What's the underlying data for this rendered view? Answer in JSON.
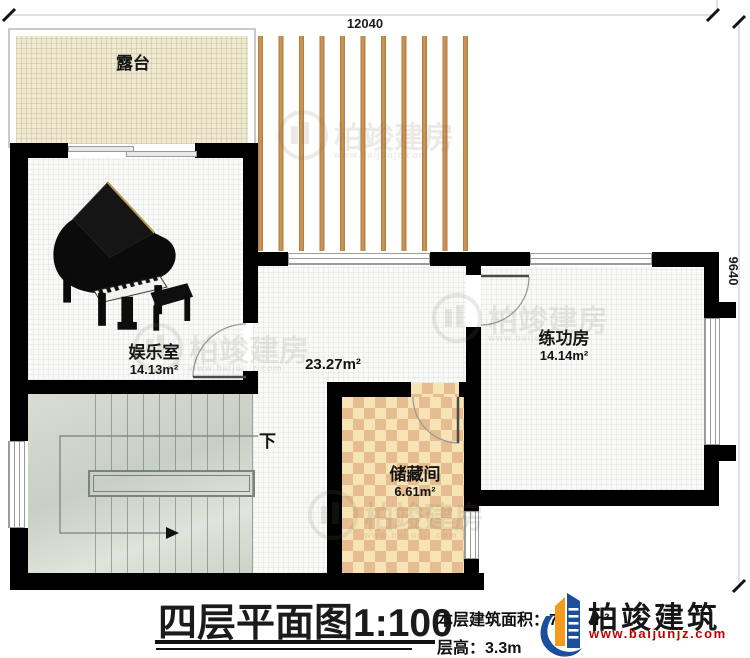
{
  "dimensions": {
    "width_label": "12040",
    "height_label": "9640"
  },
  "terrace": {
    "name": "露台"
  },
  "rooms": {
    "entertainment": {
      "name": "娱乐室",
      "area": "14.13m²"
    },
    "hall": {
      "area": "23.27m²"
    },
    "practice": {
      "name": "练功房",
      "area": "14.14m²"
    },
    "storage": {
      "name": "储藏间",
      "area": "6.61m²"
    }
  },
  "stairs": {
    "down_label": "下"
  },
  "title_block": {
    "plan_title": "四层平面图",
    "scale": "1:100",
    "area_label": "本层建筑面积：",
    "area_visible_value": "7",
    "area_unit": "m²",
    "floor_height_label": "层高：",
    "floor_height_value": "3.3m"
  },
  "brand": {
    "name": "柏竣建筑",
    "website": "www.baijunjz.com"
  },
  "watermark": {
    "text": "柏竣建房",
    "website": "www.baijunjz.com"
  },
  "colors": {
    "wall": "#000000",
    "slat": "#c08a4e",
    "terrace_floor": "#f0ead5",
    "storage_floor": "#e5bd90",
    "stairs_floor": "#ccd3c9",
    "brand_blue": "#1b4e9b",
    "brand_orange": "#f59a1d",
    "url_red": "#c00000"
  }
}
